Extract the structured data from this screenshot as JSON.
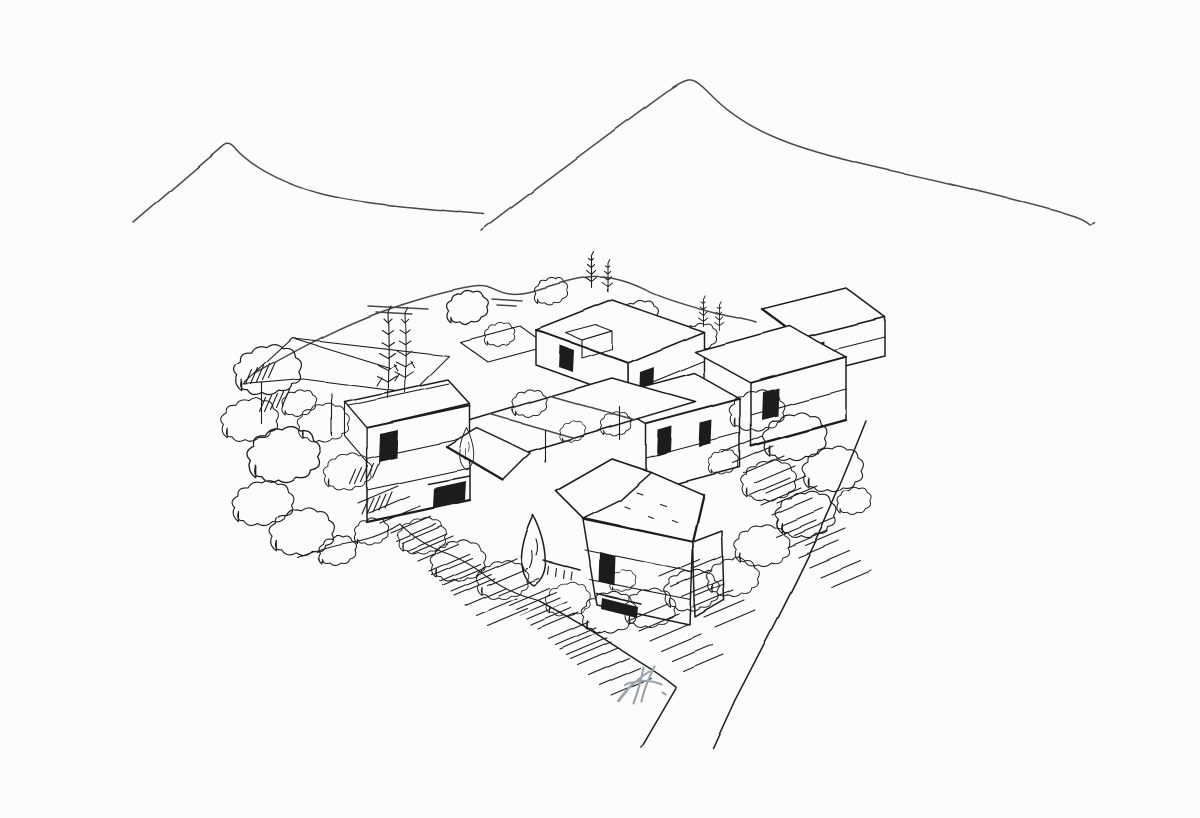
{
  "artwork": {
    "label": "Hand-drawn ink concept sketch: aerial perspective of a clustered timber housing village set between two mountain peaks, surrounded by trees, terraced slope hatching and a curved access road",
    "medium": "pen and ink freehand sketch on white paper",
    "paper_color": "#fcfcfc",
    "ink_color": "#1f1f1f",
    "light_ink_color": "#4a4a4a",
    "signature_color": "#9aa2ab",
    "elements": {
      "mountain_left": "low mountain ridge outline, upper left",
      "mountain_right": "tall pointed mountain outline, upper centre-right",
      "foothills": "rolling foothill line with short shading dashes behind the village",
      "village": "cluster of gabled blocks with hatched standing-seam roofs, vertically battened facades, flat canopy decks and an open pavilion frame",
      "trees": "tall conifers, small pines, pointed cypress and scribbled broadleaf tree clumps",
      "terrain_hatching": "bands of short parallel strokes indicating terraced slopes",
      "road": "curved access road running to the lower right corner",
      "signature": "light pencil monogram near the lower centre"
    }
  },
  "signature": {
    "monogram": "RA"
  }
}
